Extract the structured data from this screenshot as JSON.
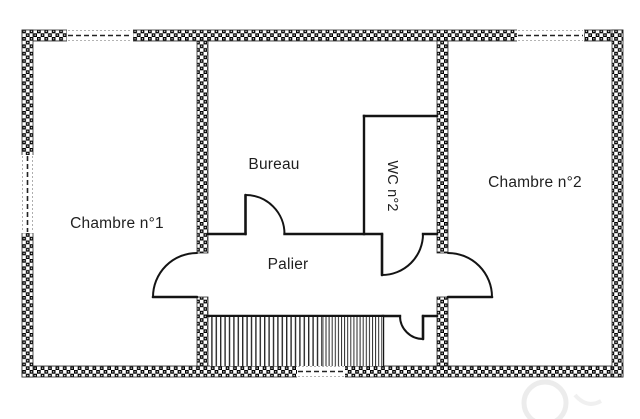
{
  "plan": {
    "title": "floor-plan-first-floor",
    "rooms": {
      "chambre1": {
        "label": "Chambre n°1"
      },
      "bureau": {
        "label": "Bureau"
      },
      "wc": {
        "label": "WC n°2"
      },
      "palier": {
        "label": "Palier"
      },
      "chambre2": {
        "label": "Chambre n°2"
      }
    },
    "colors": {
      "wall_pattern": "#000000",
      "interior_line": "#1a1a1a",
      "background": "#ffffff",
      "text": "#1f1f1f",
      "watermark": "#ececec"
    }
  }
}
